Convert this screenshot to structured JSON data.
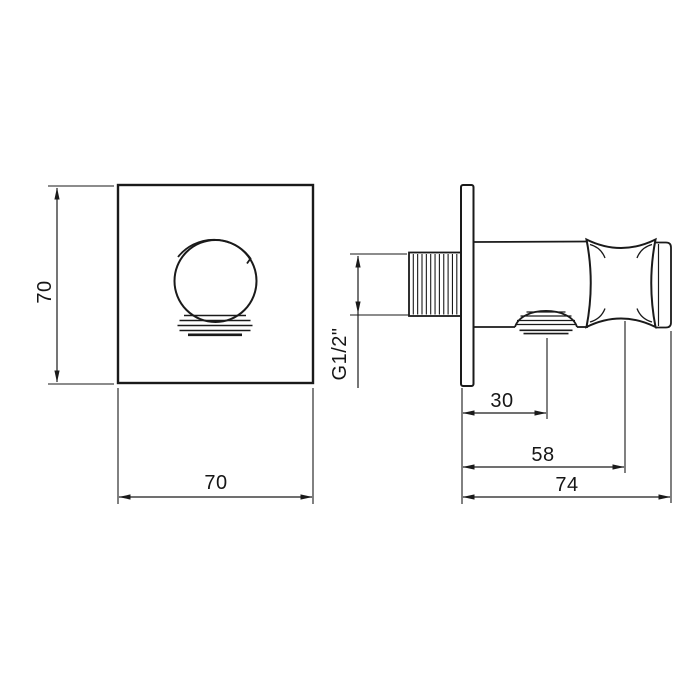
{
  "drawing": {
    "dims": {
      "front_height": "70",
      "front_width": "70",
      "thread_size": "G1/2\"",
      "wall_to_outlet": "30",
      "wall_to_holder": "58",
      "total_depth": "74"
    },
    "colors": {
      "line": "#1a1a1a",
      "background": "#ffffff"
    }
  }
}
